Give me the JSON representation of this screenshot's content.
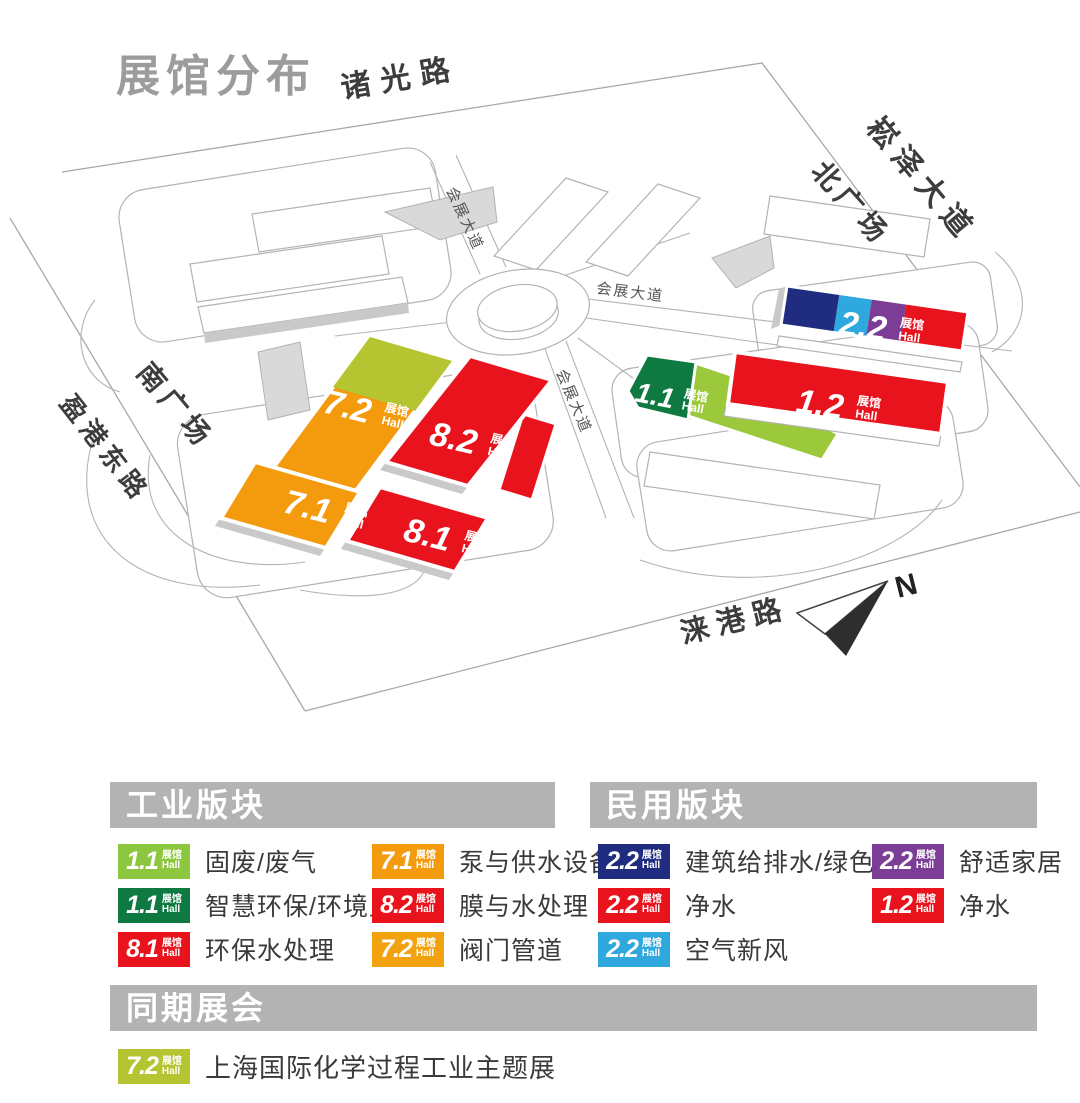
{
  "title": "展馆分布",
  "hall_suffix": {
    "zh": "展馆",
    "en": "Hall"
  },
  "colors": {
    "red": "#E8131D",
    "orange": "#F49A0D",
    "amber": "#F2A20F",
    "light_green": "#8DC63F",
    "map_light_green": "#9CC93C",
    "yellow_green": "#B5C431",
    "dark_green": "#0E7A42",
    "navy": "#1F2C80",
    "light_blue": "#2FA8DD",
    "purple": "#7C3D96",
    "header_gray": "#B3B3B3",
    "title_gray": "#9C9C9C"
  },
  "map": {
    "compass": "N",
    "roads": {
      "zhuguang": "诸光路",
      "songze": "崧泽大道",
      "north_plaza": "北广场",
      "south_plaza": "南广场",
      "yinggang": "盈港东路",
      "laigang": "涞港路",
      "expo_ave_nw": "会展大道",
      "expo_ave_e": "会展大道",
      "expo_ave_s": "会展大道"
    },
    "halls": {
      "h72": "7.2",
      "h71": "7.1",
      "h82": "8.2",
      "h81": "8.1",
      "h11": "1.1",
      "h12": "1.2",
      "h22": "2.2"
    }
  },
  "legend": {
    "industrial": {
      "header": "工业版块",
      "items": [
        {
          "num": "1.1",
          "label": "固废/废气",
          "color": "#8DC63F"
        },
        {
          "num": "1.1",
          "label": "智慧环保/环境监测",
          "color": "#0E7A42"
        },
        {
          "num": "8.1",
          "label": "环保水处理",
          "color": "#E8131D"
        },
        {
          "num": "7.1",
          "label": "泵与供水设备",
          "color": "#F49A0D"
        },
        {
          "num": "8.2",
          "label": "膜与水处理",
          "color": "#E8131D"
        },
        {
          "num": "7.2",
          "label": "阀门管道",
          "color": "#F2A20F"
        }
      ]
    },
    "civil": {
      "header": "民用版块",
      "items": [
        {
          "num": "2.2",
          "label": "建筑给排水/绿色建材",
          "color": "#1F2C80"
        },
        {
          "num": "2.2",
          "label": "净水",
          "color": "#E8131D"
        },
        {
          "num": "2.2",
          "label": "空气新风",
          "color": "#2FA8DD"
        },
        {
          "num": "2.2",
          "label": "舒适家居",
          "color": "#7C3D96"
        },
        {
          "num": "1.2",
          "label": "净水",
          "color": "#E8131D"
        }
      ]
    },
    "concurrent": {
      "header": "同期展会",
      "items": [
        {
          "num": "7.2",
          "label": "上海国际化学过程工业主题展",
          "color": "#B5C431"
        }
      ]
    }
  }
}
